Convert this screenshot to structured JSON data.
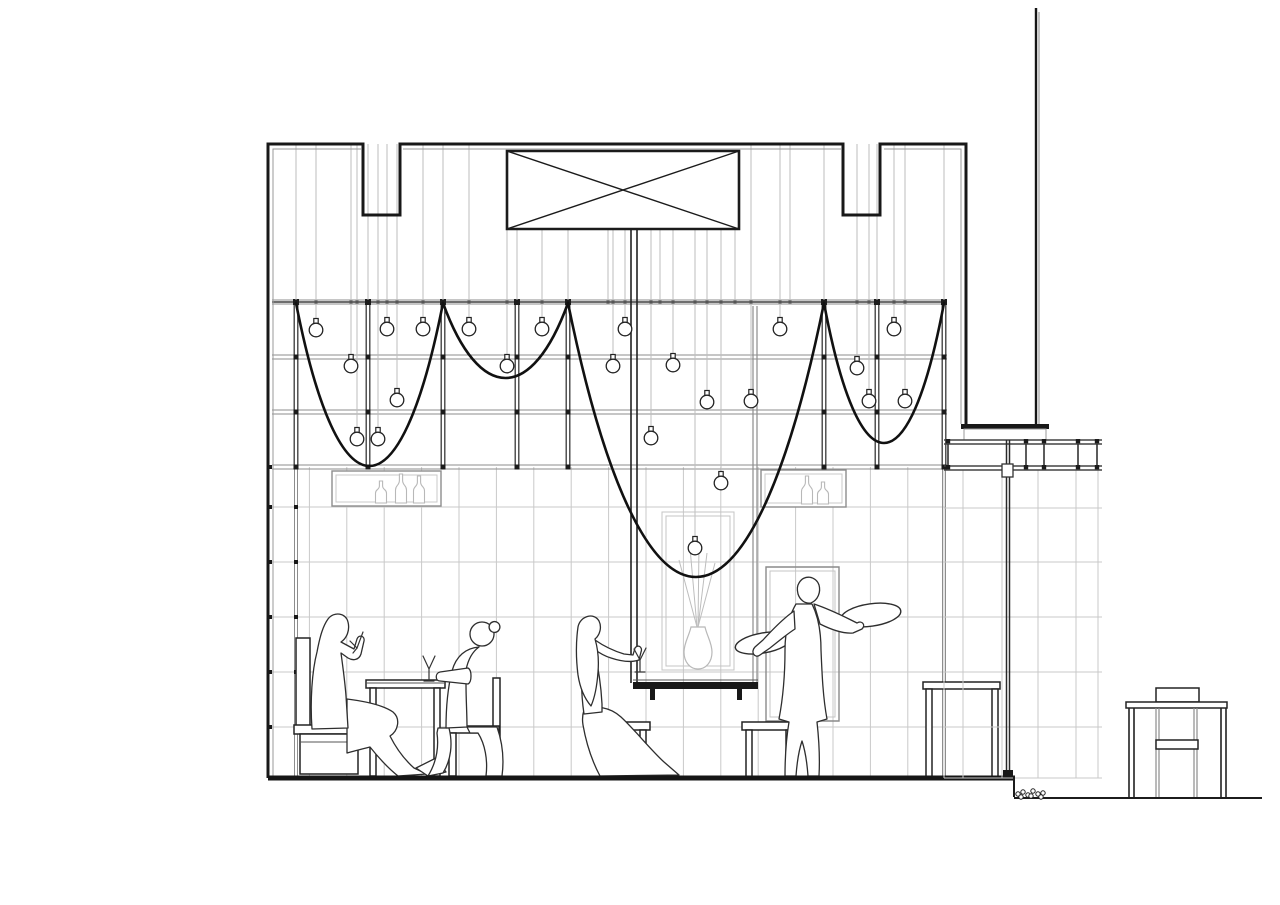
{
  "meta": {
    "type": "architectural-section-drawing",
    "subject": "restaurant interior section with suspended lattice, draped cables, hanging bulbs, diners and waiter",
    "background": "#ffffff"
  },
  "palette": {
    "ink": "#181818",
    "line_dark": "#383838",
    "line_mid": "#8d8d8d",
    "line_light": "#c9c9c9",
    "cable": "#bdbdbd",
    "swag": "#111111",
    "figure_outline": "#2e2e2e"
  },
  "canvas": {
    "width": 1280,
    "height": 905
  },
  "building": {
    "left": 268,
    "right": 966,
    "top": 144,
    "floor": 778,
    "notches": [
      {
        "x1": 363,
        "x2": 400,
        "bottom": 215
      },
      {
        "x1": 843,
        "x2": 880,
        "bottom": 215
      }
    ],
    "beam_box": {
      "x": 507,
      "y": 151,
      "w": 232,
      "h": 78
    },
    "mast": {
      "x": 1036,
      "top": 8,
      "bottom": 424
    },
    "cap": {
      "x": 961,
      "y": 424,
      "w": 88,
      "h": 5
    },
    "cap_base": {
      "x": 964,
      "y": 429,
      "w": 82,
      "h": 11
    }
  },
  "ceiling_grid": {
    "x1": 272,
    "x2": 947,
    "rails": [
      302,
      357,
      412,
      467
    ],
    "posts": [
      296,
      368,
      443,
      517,
      568,
      824,
      877,
      944
    ]
  },
  "suspension": {
    "top_y": 144,
    "box_bottom_y": 229,
    "box_span": [
      507,
      739
    ],
    "extra_cables": [
      608,
      660,
      735,
      790
    ]
  },
  "swags": [
    {
      "x1": 296,
      "x2": 443,
      "dip_y": 466
    },
    {
      "x1": 443,
      "x2": 568,
      "dip_y": 378
    },
    {
      "x1": 568,
      "x2": 824,
      "dip_y": 577
    },
    {
      "x1": 824,
      "x2": 944,
      "dip_y": 443
    }
  ],
  "bulbs": [
    [
      316,
      330
    ],
    [
      387,
      329
    ],
    [
      423,
      329
    ],
    [
      469,
      329
    ],
    [
      542,
      329
    ],
    [
      625,
      329
    ],
    [
      780,
      329
    ],
    [
      894,
      329
    ],
    [
      351,
      366
    ],
    [
      507,
      366
    ],
    [
      613,
      366
    ],
    [
      673,
      365
    ],
    [
      857,
      368
    ],
    [
      397,
      400
    ],
    [
      707,
      402
    ],
    [
      751,
      401
    ],
    [
      869,
      401
    ],
    [
      905,
      401
    ],
    [
      357,
      439
    ],
    [
      378,
      439
    ],
    [
      651,
      438
    ],
    [
      721,
      483
    ],
    [
      695,
      548
    ]
  ],
  "wall_grid": {
    "x1": 272,
    "x2": 945,
    "y1": 467,
    "y2": 776,
    "col_step": 37.4,
    "rows": [
      507,
      562,
      617,
      672,
      727
    ],
    "mullions": [
      296,
      944
    ],
    "node_cols": [
      270,
      296
    ],
    "node_rows": [
      467,
      507,
      562,
      617,
      672,
      727
    ]
  },
  "shelves": [
    {
      "x": 332,
      "y": 471,
      "w": 109,
      "h": 35,
      "bottles": [
        {
          "x": 381,
          "h": 22
        },
        {
          "x": 401,
          "h": 29
        },
        {
          "x": 419,
          "h": 27
        }
      ]
    },
    {
      "x": 761,
      "y": 470,
      "w": 85,
      "h": 37,
      "bottles": [
        {
          "x": 807,
          "h": 28
        },
        {
          "x": 823,
          "h": 22
        }
      ]
    }
  ],
  "right_structure": {
    "rail_x1": 944,
    "rail_x2": 1102,
    "rails_top": [
      440,
      444
    ],
    "rails_bottom": [
      466,
      470
    ],
    "balusters": [
      948,
      1026,
      1044,
      1078,
      1097
    ],
    "pole": {
      "x1": 1006.5,
      "x2": 1009.5,
      "top": 440,
      "bottom": 772,
      "node": {
        "x": 1002,
        "y": 464,
        "w": 11,
        "h": 13
      },
      "foot": {
        "x": 1003,
        "y": 770,
        "w": 10,
        "h": 7
      }
    },
    "trellis": {
      "cols": [
        944,
        963,
        1002,
        1038,
        1076,
        1098
      ],
      "col_y1": 470,
      "col_y2": 778,
      "rows": [
        508,
        562,
        617,
        672,
        727,
        778
      ]
    }
  },
  "ground": {
    "step_x": 1014,
    "main_floor_y": 778,
    "lower_y": 798,
    "right_end": 1262,
    "gravel": [
      [
        1018,
        794
      ],
      [
        1023,
        792
      ],
      [
        1028,
        795
      ],
      [
        1033,
        791
      ],
      [
        1038,
        794
      ],
      [
        1043,
        793
      ],
      [
        1021,
        797
      ],
      [
        1031,
        796
      ],
      [
        1041,
        797
      ]
    ]
  },
  "labels": {
    "figures": [
      "diner-drinking-man",
      "diner-seated-woman",
      "woman-on-stool",
      "waiter-with-trays"
    ],
    "furniture": [
      "bench",
      "dining-table",
      "chair",
      "stool",
      "stool",
      "high-counter",
      "door-frame",
      "kiosk"
    ]
  },
  "paths": {
    "building_shell": "M268,778 L268,144 L363,144 L363,215 L400,215 L400,144 L843,144 L843,215 L880,215 L880,144 L966,144 L966,424",
    "building_inner": "M273,776 L273,149 L361,149 M403,149 L841,149 M884,149 L961,149 L961,424",
    "xbox_rect": "M507,151 L739,151 L739,229 L507,229 Z",
    "xbox_diag": "M507,151 L739,229 M739,151 L507,229",
    "mast_main": "M1036,8 L1036,424",
    "mast_thin": "M1039,12 L1039,424",
    "cap_fill": "M961,424 L1049,424 L1049,429 L961,429 Z",
    "cap_base": "M964,429 L1046,429 L1046,440 L964,440 Z",
    "column_pair": "M631,229 L631,683 M637,229 L637,683",
    "niche_right_pair": "M753,306 L753,683 M757,306 L757,683",
    "niche_inner": "M662,512 L734,512 L734,670 L662,670 Z",
    "niche_inner2": "M666,516 L730,516 L730,666 L666,666 Z",
    "vase": "M691,627 C689,636 684,643 684,652 C684,662 690,669 698,669 C706,669 712,662 712,652 C712,643 707,636 705,627 Z",
    "stems": "M697,627 L679,560 M697,627 L690,548 M698,627 L699,545 M698,627 L707,553 M698,627 L715,563",
    "mirror_outer": "M766,567 L839,567 L839,721 L766,721 Z",
    "mirror_inner": "M770,571 L835,571 L835,717 L770,717 Z",
    "counter_slab": "M633,682 L758,682 L758,689 L633,689 Z",
    "counter_line": "M633,680 L758,680",
    "counter_feet": "M650,689 L655,689 L655,700 L650,700 Z M737,689 L742,689 L742,700 L737,700 Z",
    "bench_back": "M296,638 L310,638 L310,726 L296,726 Z",
    "bench_seat": "M294,725 L368,725 L368,734 L294,734 Z",
    "bench_base": "M300,734 L358,734 L358,774 L300,774 Z",
    "bench_base_line": "M300,742 L358,742",
    "table_top": "M366,680 L445,680 L445,688 L366,688 Z",
    "table_line": "M366,683 L445,683",
    "table_legs": "M370,688 L376,688 L376,776 L370,776 Z M434,688 L440,688 L440,776 L434,776 Z",
    "chair_back": "M493,678 L500,678 L500,776 L493,776 Z",
    "chair_seat": "M447,726 L499,726 L499,733 L447,733 Z",
    "chair_leg": "M449,733 L456,733 L456,776 L449,776 Z",
    "stool1_top": "M596,722 L650,722 L650,730 L596,730 Z",
    "stool1_legs": "M600,730 L606,730 L606,776 L600,776 Z M640,730 L646,730 L646,776 L640,776 Z",
    "stool2_top": "M742,722 L796,722 L796,730 L742,730 Z",
    "stool2_legs": "M746,730 L752,730 L752,778 L746,778 Z M786,730 L792,730 L792,778 L786,778 Z",
    "doorframe_top": "M923,682 L1000,682 L1000,689 L923,689 Z",
    "doorframe_legs": "M926,689 L932,689 L932,778 L926,778 Z M992,689 L998,689 L998,778 L992,778 Z",
    "man_legs": "M347,699 C363,701 383,705 393,712 C401,719 398,731 390,736 C396,748 405,760 414,768 L427,774 L398,776 C388,768 378,757 370,747 C362,749 354,751 347,753 Z",
    "man_foot": "M416,768 L436,758 L446,772 L428,776 Z",
    "man_body": "M328,619 C334,611 346,613 348,622 C350,630 347,638 341,642 L354,649 L357,639 C359,634 365,636 364,641 L361,654 C359,660 353,661 348,658 L341,653 C343,668 345,682 346,696 L348,728 L312,729 C310,701 312,671 317,652 C320,636 323,626 328,619 Z",
    "glass_man": "M350,641 L357,648 L363,632 M357,648 L353,653",
    "woman_head": "M470,634 A12,12 0 1 1 494,634 A12,12 0 1 1 470,634 Z",
    "woman_bun": "M490,624 A4.5,4.5 0 1 1 499,630 A4.5,4.5 0 1 1 490,624 Z",
    "woman_torso": "M479,647 C472,652 468,660 466,670 L466,684 C466,700 467,713 467,727 L446,728 C446,706 448,687 452,671 C456,656 466,648 479,647 Z",
    "woman_arm": "M468,668 L440,672 C435,673 435,681 440,681 L468,684 C472,682 472,670 468,668 Z",
    "woman_dress": "M467,727 L497,727 C503,744 504,761 502,776 L486,776 C488,760 485,744 478,733 L470,733 Z",
    "woman_legs": "M449,728 C453,744 451,760 443,773 L428,776 C436,763 439,748 437,733 L438,728 Z",
    "glass_table": "M423,656 L429,669 L435,656 M429,669 L429,680 M424,681 L434,681",
    "w3_hair": "M578,627 C580,616 594,612 599,621 C602,627 600,635 595,639 C598,649 599,660 598,672 C597,686 595,697 591,706 C585,699 580,688 578,675 C576,659 576,641 578,627 Z",
    "w3_body": "M595,640 C605,647 614,651 624,654 L633,655 L635,648 C638,644 643,647 641,652 L639,660 C630,663 620,661 611,658 C604,656 598,652 594,649 C598,666 601,684 602,704 L602,712 L584,714 C581,694 581,672 583,653 C585,645 589,641 595,640 Z",
    "w3_dress": "M584,710 C596,705 610,707 621,717 C635,730 649,748 664,762 L679,775 L600,776 C592,761 586,742 583,725 C582,719 583,713 584,710 Z",
    "glass_w3": "M634,649 L640,660 L646,648 M640,660 L640,671 M635,672 L645,672",
    "tray_left": "M735.4,647.9 A28,10 -10 1 1 790.6,638.1 A28,10 -10 1 1 735.4,647.9 Z",
    "tray_right": "M841.3,619.2 A30,11 -8 1 1 900.7,610.8 A30,11 -8 1 1 841.3,619.2 Z",
    "waiter_body": "M796,604 L812,604 C818,616 821,632 821,650 C822,674 823,698 827,719 L817,722 C819,740 820,758 819,776 L808,776 C807,762 805,750 802,741 C799,750 797,762 796,776 L785,776 C785,758 786,740 789,722 L779,719 C783,698 785,674 785,650 C785,632 789,616 796,604 Z",
    "waiter_larm": "M794,611 C784,618 773,629 763,640 L755,647 C750,652 755,659 760,655 L770,648 C779,641 787,634 795,629 Z",
    "waiter_rarm": "M814,604 C826,608 839,614 851,620 L857,623 C862,620 866,625 862,629 L853,633 C842,634 830,629 820,624 Z",
    "waiter_head": "M799,583 C804,574 816,576 819,585 C821,592 818,600 811,603 C805,604 800,600 798,594 C797,590 797,586 799,583 Z",
    "kiosk_roof": "M1126,702 L1227,702 L1227,708 L1126,708 Z",
    "kiosk_topbox": "M1156,688 L1199,688 L1199,702 L1156,702 Z",
    "kiosk_walls": "M1129,708 L1129,798 M1134,708 L1134,798 M1221,708 L1221,798 M1226,708 L1226,798",
    "kiosk_inner": "M1156,708 L1156,798 M1159,708 L1159,798 M1194,708 L1194,798 M1197,708 L1197,798",
    "kiosk_band": "M1156,740 L1198,740 L1198,749 L1156,749 Z",
    "floor_main": "M268,778 L1015,778",
    "floor_step": "M1014,776 L1014,797",
    "ground_line": "M1014,798 L1262,798"
  }
}
